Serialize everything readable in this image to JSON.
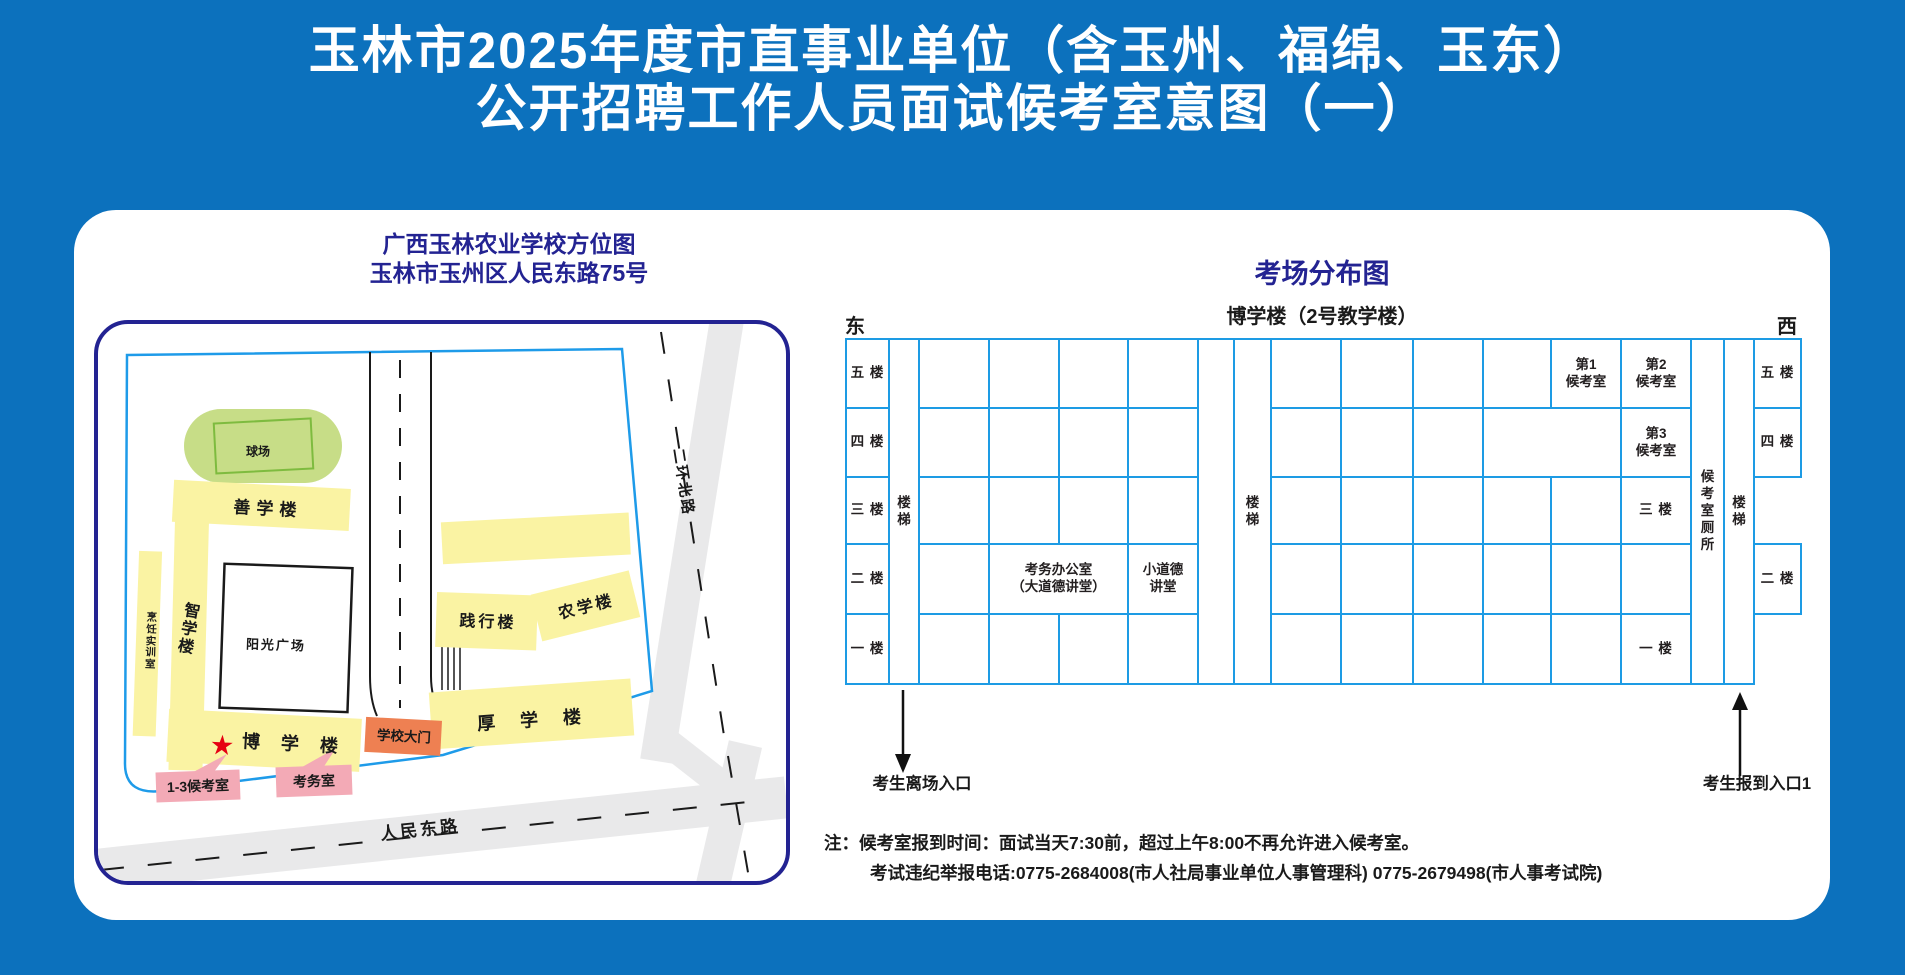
{
  "header": {
    "line1": "玉林市2025年度市直事业单位（含玉州、福绵、玉东）",
    "line2": "公开招聘工作人员面试候考室意图（一）"
  },
  "campus_map": {
    "title1": "广西玉林农业学校方位图",
    "title2": "玉林市玉州区人民东路75号",
    "labels": {
      "ball_field": "球场",
      "shan_xue": "善学楼",
      "zhi_xue": "智学楼",
      "cooking": "烹饪实训室",
      "plaza": "阳光广场",
      "bo_xue": "博 学 楼",
      "star": "★",
      "gate": "学校大门",
      "hou_xue": "厚 学 楼",
      "jian_xing": "践行楼",
      "nong_xue": "农学楼",
      "waiting_1_3": "1-3候考室",
      "exam_office": "考务室",
      "renmin_road": "人民东路",
      "erhuan_road": "二环北路"
    }
  },
  "exam_panel": {
    "title": "考场分布图",
    "building": "博学楼（2号教学楼）",
    "east": "东",
    "west": "西",
    "exit_label": "考生离场入口",
    "entrance_label": "考生报到入口1",
    "grid": {
      "col_widths": [
        43,
        30,
        70,
        70,
        69,
        70,
        36,
        37,
        70,
        72,
        70,
        68,
        70,
        70,
        33,
        30,
        47
      ],
      "row_heights": [
        69,
        69,
        67,
        70,
        70
      ],
      "rows": [
        [
          {
            "t": "五 楼",
            "cls": "floor",
            "name": "floor-label-5f-east"
          },
          {
            "t": "楼梯",
            "cls": "vs",
            "rs": 5,
            "vert": true,
            "name": "stairwell-east"
          },
          {},
          {},
          {},
          {},
          {
            "rs": 5,
            "name": "corridor"
          },
          {
            "t": "楼梯",
            "cls": "vs",
            "rs": 5,
            "vert": true,
            "name": "stairwell-middle"
          },
          {},
          {},
          {},
          {},
          {
            "t": "第1\n候考室",
            "cls": "room",
            "name": "waiting-room-1"
          },
          {
            "t": "第2\n候考室",
            "cls": "room",
            "name": "waiting-room-2"
          },
          {
            "t": "候考室厕所",
            "cls": "vt",
            "rs": 5,
            "vert": true,
            "name": "waiting-room-toilet"
          },
          {
            "t": "楼梯",
            "cls": "vs",
            "rs": 5,
            "vert": true,
            "name": "stairwell-west"
          },
          {
            "t": "五 楼",
            "cls": "floor",
            "name": "floor-label-5f-west"
          }
        ],
        [
          {
            "t": "四 楼",
            "cls": "floor",
            "name": "floor-label-4f-east"
          },
          {},
          {},
          {},
          {},
          {},
          {},
          {},
          {
            "cs": 2,
            "name": "room-cell"
          },
          {
            "t": "第3\n候考室",
            "cls": "room",
            "name": "waiting-room-3"
          },
          {
            "t": "四 楼",
            "cls": "floor",
            "name": "floor-label-4f-west"
          }
        ],
        [
          {
            "t": "三 楼",
            "cls": "floor",
            "name": "floor-label-3f-east"
          },
          {},
          {},
          {},
          {},
          {},
          {},
          {},
          {},
          {},
          {
            "t": "三 楼",
            "cls": "floor",
            "name": "floor-label-3f-west"
          }
        ],
        [
          {
            "t": "二 楼",
            "cls": "floor",
            "name": "floor-label-2f-east"
          },
          {},
          {
            "t": "考务办公室\n（大道德讲堂）",
            "cls": "office",
            "cs": 2,
            "name": "exam-affairs-office"
          },
          {
            "t": "小道德\n讲堂",
            "cls": "office",
            "name": "small-lecture-hall"
          },
          {},
          {},
          {},
          {},
          {},
          {},
          {
            "t": "二 楼",
            "cls": "floor",
            "name": "floor-label-2f-west"
          }
        ],
        [
          {
            "t": "一 楼",
            "cls": "floor",
            "name": "floor-label-1f-east"
          },
          {},
          {},
          {},
          {},
          {},
          {},
          {},
          {},
          {},
          {
            "t": "一 楼",
            "cls": "floor",
            "name": "floor-label-1f-west"
          }
        ]
      ]
    }
  },
  "notes": {
    "line1": "注：候考室报到时间：面试当天7:30前，超过上午8:00不再允许进入候考室。",
    "line2": "考试违纪举报电话:0775-2684008(市人社局事业单位人事管理科) 0775-2679498(市人事考试院)"
  },
  "colors": {
    "background_blue": "#0C71BD",
    "grid_blue": "#1D9BE4",
    "title_indigo": "#232392",
    "building_yellow": "#FAF3A3",
    "field_green": "#C7DD87",
    "field_green_border": "#7EBB3F",
    "gate_orange": "#EE8052",
    "pink_label": "#F3AAB6",
    "road_gray": "#E9E9EA",
    "star_red": "#E60012"
  }
}
